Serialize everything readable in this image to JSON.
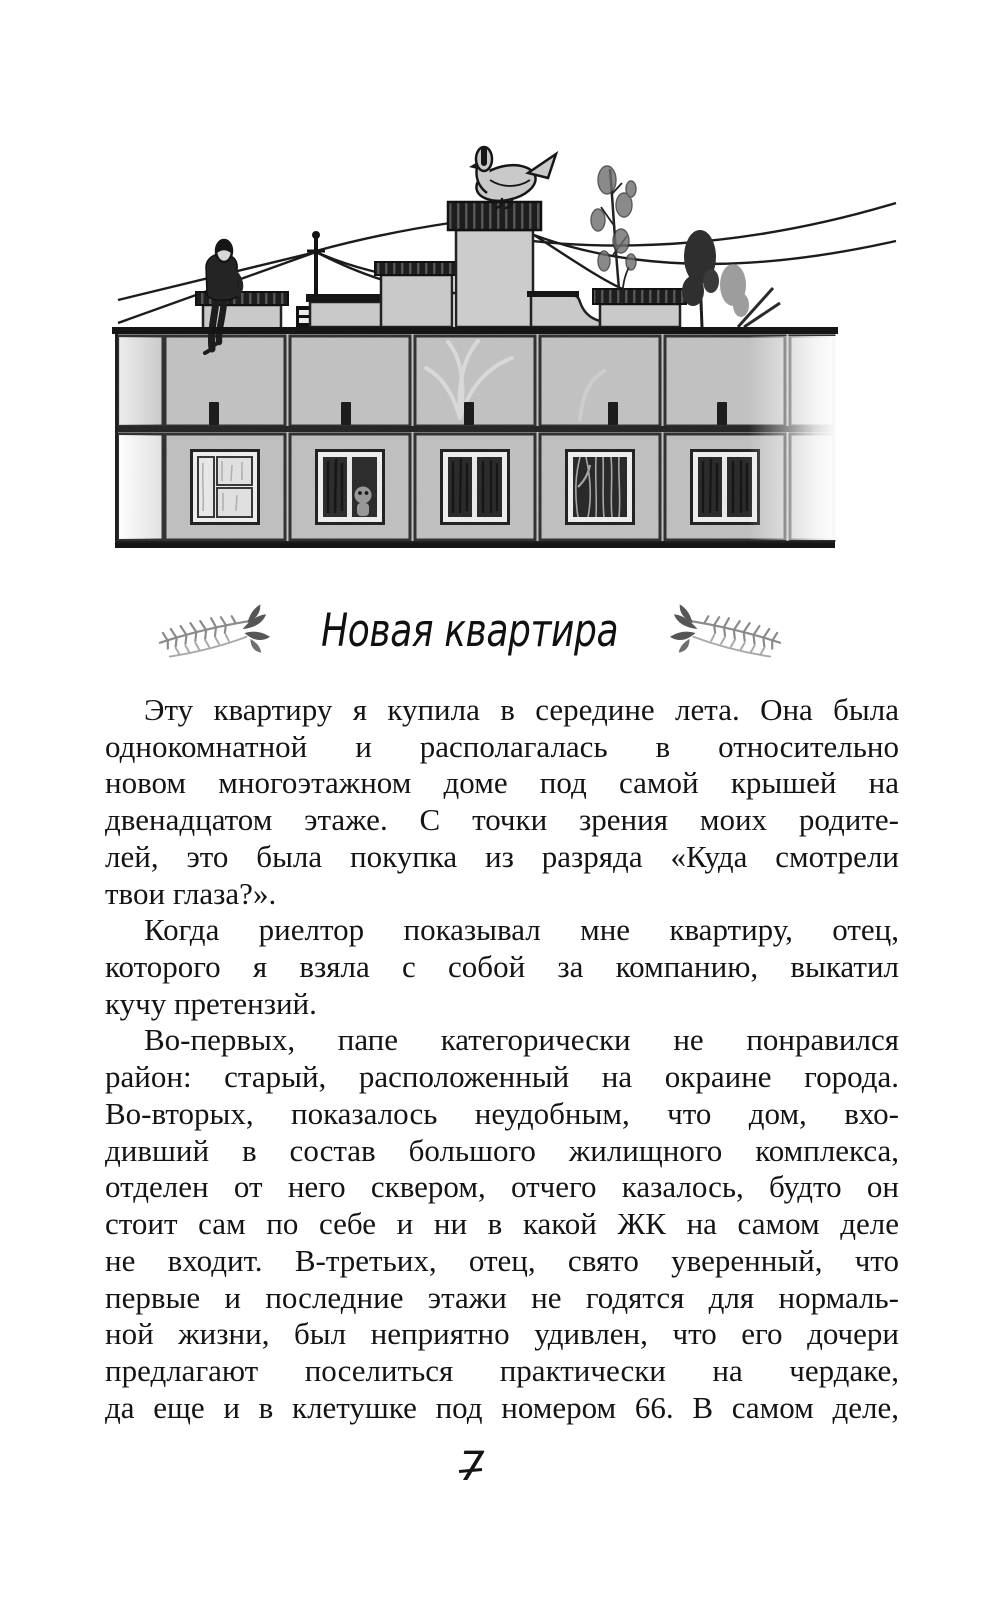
{
  "page": {
    "number": "7",
    "chapter_title": "Новая квартира",
    "ink_color": "#141414",
    "paper_color": "#ffffff"
  },
  "illustration": {
    "description": "Крыша панельного многоэтажного дома: человек сидит на краю крыши, голубь на трубе, антенна с проводами, вентиляционные будки, деревца на крыше, окна верхних этажей"
  },
  "paragraphs": [
    {
      "indent": true,
      "lines": [
        {
          "text": "Эту квартиру я купила в середине лета. Она была",
          "justify": true
        },
        {
          "text": "однокомнатной и располагалась в относительно",
          "justify": true
        },
        {
          "text": "новом многоэтажном доме под самой крышей на",
          "justify": true
        },
        {
          "text": "двенадцатом этаже. С точки зрения моих родите-",
          "justify": true
        },
        {
          "text": "лей, это была покупка из разряда «Куда смотрели",
          "justify": true
        },
        {
          "text": "твои глаза?».",
          "justify": false
        }
      ]
    },
    {
      "indent": true,
      "lines": [
        {
          "text": "Когда риелтор показывал мне квартиру, отец,",
          "justify": true
        },
        {
          "text": "которого я взяла с собой за компанию, выкатил",
          "justify": true
        },
        {
          "text": "кучу претензий.",
          "justify": false
        }
      ]
    },
    {
      "indent": true,
      "lines": [
        {
          "text": "Во-первых, папе категорически не понравился",
          "justify": true
        },
        {
          "text": "район: старый, расположенный на окраине города.",
          "justify": true
        },
        {
          "text": "Во-вторых, показалось неудобным, что дом, вхо-",
          "justify": true
        },
        {
          "text": "дивший в состав большого жилищного комплекса,",
          "justify": true
        },
        {
          "text": "отделен от него сквером, отчего казалось, будто он",
          "justify": true
        },
        {
          "text": "стоит сам по себе и ни в какой ЖК на самом деле",
          "justify": true
        },
        {
          "text": "не входит. В-третьих, отец, свято уверенный, что",
          "justify": true
        },
        {
          "text": "первые и последние этажи не годятся для нормаль-",
          "justify": true
        },
        {
          "text": "ной жизни, был неприятно удивлен, что его дочери",
          "justify": true
        },
        {
          "text": "предлагают поселиться практически на чердаке,",
          "justify": true
        },
        {
          "text": "да еще и в клетушке под номером 66. В самом деле,",
          "justify": true
        }
      ]
    }
  ]
}
